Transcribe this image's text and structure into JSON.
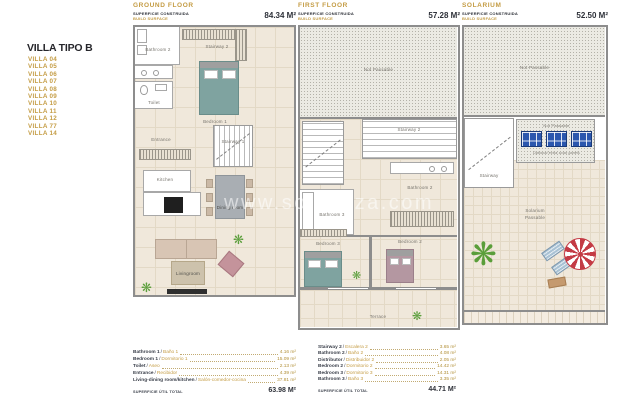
{
  "colors": {
    "gold": "#C49C44",
    "ink": "#2D3038",
    "wall": "#8D8D8D",
    "floor": "#F0E8DB",
    "teal_bed": "#7FA3A0",
    "mauve_bed": "#B497A1",
    "panel_blue": "#2B57AE",
    "parasol_red": "#C43B45"
  },
  "sidebar": {
    "title": "VILLA TIPO B",
    "items": [
      "VILLA 04",
      "VILLA 05",
      "VILLA 06",
      "VILLA 07",
      "VILLA 08",
      "VILLA 09",
      "VILLA 10",
      "VILLA 11",
      "VILLA 12",
      "VILLA 77",
      "VILLA 14"
    ]
  },
  "watermark": "www.solvanza.com",
  "icons": {
    "plant": "❋"
  },
  "plans": [
    {
      "title": "GROUND FLOOR",
      "surface_es": "SUPERFICIE CONSTRUIDA",
      "surface_en": "BUILD SURFACE",
      "area": "84.34 M²",
      "labels": {
        "bathroom": "Bathroom 2",
        "stairway_top": "Stairway 2",
        "toilet": "Toilet",
        "bedroom": "Bedroom 1",
        "entrance": "Entrance",
        "stairway_mid": "Stairway 1",
        "kitchen": "Kitchen",
        "dining": "Dining room",
        "living": "Livingroom"
      },
      "legend": {
        "rows": [
          {
            "en": "Bathroom 1",
            "es": "Baño 1",
            "val": "4.16 m²"
          },
          {
            "en": "Bedroom 1",
            "es": "Dormitorio 1",
            "val": "15.09 m²"
          },
          {
            "en": "Toilet",
            "es": "Aseo",
            "val": "2.13 m²"
          },
          {
            "en": "Entrance",
            "es": "Recibidor",
            "val": "4.39 m²"
          },
          {
            "en": "Living-dining room/kitchen",
            "es": "Salón-comedor-cocina",
            "val": "37.81 m²"
          }
        ],
        "total_label": "SUPERFICIE ÚTIL TOTAL",
        "total": "63.98 M²"
      }
    },
    {
      "title": "FIRST FLOOR",
      "surface_es": "SUPERFICIE CONSTRUIDA",
      "surface_en": "BUILD SURFACE",
      "area": "57.28 M²",
      "labels": {
        "not_passable": "Not Passable",
        "stairway": "Stairway 2",
        "bathroom2": "Bathroom 2",
        "bathroom3": "Bathroom 3",
        "bedroom3": "Bedroom 3",
        "bedroom2": "Bedroom 2",
        "terrace": "Terrace"
      },
      "legend": {
        "rows": [
          {
            "en": "Stairway 2",
            "es": "Escalera 2",
            "val": "3.65 m²"
          },
          {
            "en": "Bathroom 2",
            "es": "Baño 2",
            "val": "4.08 m²"
          },
          {
            "en": "Distributor",
            "es": "Distribuidor 2",
            "val": "2.05 m²"
          },
          {
            "en": "Bedroom 2",
            "es": "Dormitorio 2",
            "val": "14.42 m²"
          },
          {
            "en": "Bedroom 3",
            "es": "Dormitorio 3",
            "val": "14.31 m²"
          },
          {
            "en": "Bathroom 3",
            "es": "Baño 3",
            "val": "3.35 m²"
          }
        ],
        "total_label": "SUPERFICIE ÚTIL TOTAL",
        "total": "44.71 M²"
      }
    },
    {
      "title": "SOLARIUM",
      "surface_es": "SUPERFICIE CONSTRUIDA",
      "surface_en": "BUILD SURFACE",
      "area": "52.50 M²",
      "labels": {
        "not_passable_top": "Not Passable",
        "stairway": "Stairway",
        "not_passable_panels": "Not Passable",
        "panels_note": "Optional extra solar panels",
        "solarium_line1": "Solarium",
        "solarium_line2": "Passable"
      }
    }
  ]
}
